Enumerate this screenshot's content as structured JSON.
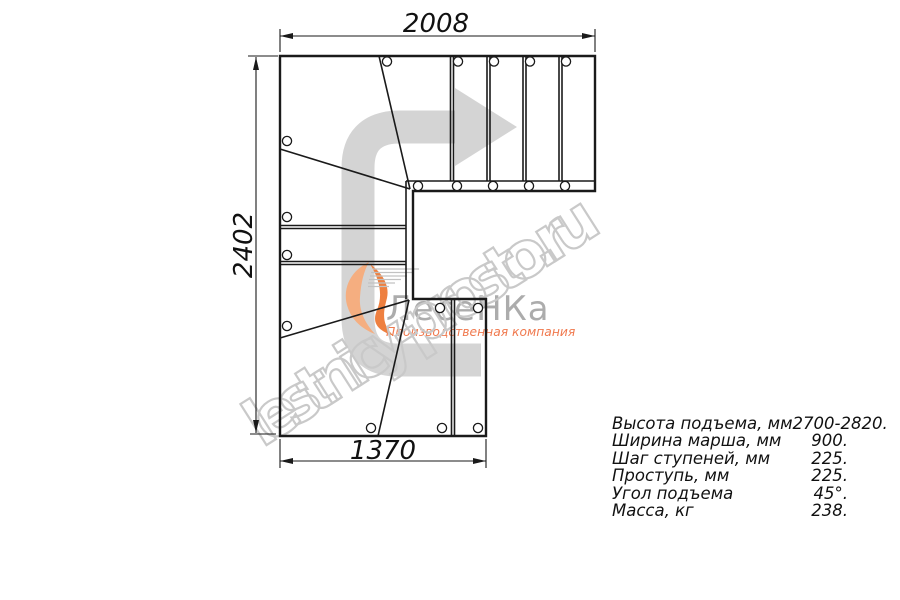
{
  "drawing": {
    "type": "stair-plan-top-view",
    "dimension_labels": {
      "top": "2008",
      "left": "2402",
      "bottom": "1370"
    }
  },
  "specs": {
    "rows": [
      {
        "label": "Высота подъема, мм",
        "value": "2700-2820."
      },
      {
        "label": "Ширина марша, мм",
        "value": "900."
      },
      {
        "label": "Шаг ступеней, мм",
        "value": "225."
      },
      {
        "label": "Проступь, мм",
        "value": "225."
      },
      {
        "label": "Угол подъема",
        "value": "45°."
      },
      {
        "label": "Масса, кг",
        "value": "238."
      }
    ]
  },
  "logo": {
    "brand": "ЛесеНКа",
    "tagline": "Производственная компания"
  },
  "watermark": {
    "text": "lestnicy-prosto.ru"
  },
  "colors": {
    "line_black": "#1a1a1a",
    "mark_gray": "#d4d4d4",
    "watermark_outline": "#c9c9c9",
    "logo_text_gray": "#acacac",
    "logo_orange": "#ee8040",
    "logo_orange_light": "#f5ae80",
    "tagline_orange": "#f0794e"
  }
}
